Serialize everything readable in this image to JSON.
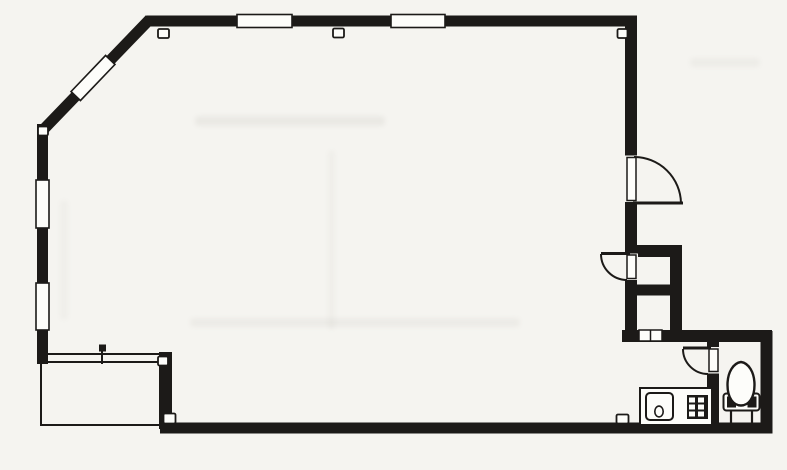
{
  "scene": {
    "width": 787,
    "height": 470,
    "background": "#f5f4f0",
    "paper": "#fdfdfa",
    "ink": "#1c1a18",
    "description": "Scanned architectural floor plan: large open room with angled corner, closet, kitchenette counter with sink and burner, WC with toilet, and balcony step-out"
  },
  "walls": [
    {
      "name": "top-wall",
      "x1": 147,
      "y1": 21,
      "x2": 637,
      "y2": 21,
      "w": 11
    },
    {
      "name": "diagonal-wall",
      "x1": 150,
      "y1": 19,
      "x2": 43,
      "y2": 130,
      "w": 11
    },
    {
      "name": "left-wall",
      "x1": 42.5,
      "y1": 124,
      "x2": 42.5,
      "y2": 364,
      "w": 11
    },
    {
      "name": "right-wall-upper",
      "x1": 631,
      "y1": 15.5,
      "x2": 631,
      "y2": 156,
      "w": 12
    },
    {
      "name": "right-wall-mid",
      "x1": 631,
      "y1": 202,
      "x2": 631,
      "y2": 254,
      "w": 12
    },
    {
      "name": "right-wall-lower",
      "x1": 631,
      "y1": 280,
      "x2": 631,
      "y2": 342,
      "w": 12
    },
    {
      "name": "closet-top-wall",
      "x1": 625,
      "y1": 251,
      "x2": 682,
      "y2": 251,
      "w": 12
    },
    {
      "name": "closet-right-wall",
      "x1": 676,
      "y1": 245,
      "x2": 676,
      "y2": 342,
      "w": 12
    },
    {
      "name": "closet-divider-wall",
      "x1": 625,
      "y1": 290,
      "x2": 682,
      "y2": 290,
      "w": 11
    },
    {
      "name": "service-top-wall",
      "x1": 622,
      "y1": 336,
      "x2": 772,
      "y2": 336,
      "w": 12
    },
    {
      "name": "wc-left-wall",
      "x1": 713,
      "y1": 331,
      "x2": 713,
      "y2": 430,
      "w": 12
    },
    {
      "name": "wc-right-wall",
      "x1": 766.5,
      "y1": 331,
      "x2": 766.5,
      "y2": 433,
      "w": 12
    },
    {
      "name": "bottom-wall",
      "x1": 160,
      "y1": 428,
      "x2": 772.5,
      "y2": 428,
      "w": 11
    },
    {
      "name": "balcony-right-wall",
      "x1": 165.5,
      "y1": 352,
      "x2": 165.5,
      "y2": 429,
      "w": 13
    }
  ],
  "thin_lines": [
    {
      "name": "balcony-top-line-outer",
      "x1": 40,
      "y1": 354,
      "x2": 160,
      "y2": 354
    },
    {
      "name": "balcony-top-line-inner",
      "x1": 40,
      "y1": 362,
      "x2": 160,
      "y2": 362
    },
    {
      "name": "balcony-left-line",
      "x1": 41,
      "y1": 362,
      "x2": 41,
      "y2": 426
    },
    {
      "name": "balcony-bottom-line",
      "x1": 41,
      "y1": 425,
      "x2": 162,
      "y2": 425
    },
    {
      "name": "balcony-tick-line",
      "x1": 102,
      "y1": 346,
      "x2": 102,
      "y2": 364
    }
  ],
  "windows": [
    {
      "name": "window-top-left",
      "cx": 264.5,
      "cy": 21,
      "len": 55,
      "th": 13,
      "rot": 0
    },
    {
      "name": "window-top-right",
      "cx": 418,
      "cy": 21,
      "len": 54,
      "th": 13,
      "rot": 0
    },
    {
      "name": "window-diagonal",
      "cx": 93,
      "cy": 78,
      "len": 50,
      "th": 13,
      "rot": -46.3
    },
    {
      "name": "window-left-upper",
      "cx": 42.5,
      "cy": 204,
      "len": 48,
      "th": 13,
      "rot": 90
    },
    {
      "name": "window-left-lower",
      "cx": 42.5,
      "cy": 306.5,
      "len": 47,
      "th": 13,
      "rot": 90
    }
  ],
  "doors": [
    {
      "name": "entry-door",
      "opening": {
        "x": 624,
        "y": 155.5,
        "w": 14,
        "h": 46.5
      },
      "slot": {
        "x": 627,
        "y": 157.5,
        "w": 9,
        "h": 43
      },
      "leaf": {
        "x1": 633,
        "y1": 203,
        "x2": 683,
        "y2": 203
      },
      "arc": "M 634 157 A 47 47 0 0 1 681 203"
    },
    {
      "name": "closet-door",
      "opening": {
        "x": 624,
        "y": 253.5,
        "w": 14,
        "h": 26.5
      },
      "slot": {
        "x": 627,
        "y": 255,
        "w": 9,
        "h": 23.5
      },
      "leaf": {
        "x1": 601,
        "y1": 253.5,
        "x2": 630,
        "y2": 253.5
      },
      "arc": "M 601 254 A 26 26 0 0 0 627 280"
    },
    {
      "name": "wc-door",
      "opening": {
        "x": 706.5,
        "y": 347,
        "w": 13,
        "h": 26.5
      },
      "slot": {
        "x": 709,
        "y": 349,
        "w": 9,
        "h": 22.5
      },
      "leaf": {
        "x1": 683,
        "y1": 348,
        "x2": 711,
        "y2": 348
      },
      "arc": "M 683 349 A 25 25 0 0 0 708 374"
    }
  ],
  "hatch": {
    "name": "closet-hatch",
    "x": 639,
    "y": 330,
    "w": 23,
    "h": 11,
    "divider_x": 650.5
  },
  "markers": [
    {
      "name": "column-marker-top-left",
      "x": 158,
      "y": 29,
      "w": 11,
      "h": 9
    },
    {
      "name": "column-marker-top-mid",
      "x": 333,
      "y": 28.5,
      "w": 11,
      "h": 9
    },
    {
      "name": "column-marker-top-right",
      "x": 617.5,
      "y": 29,
      "w": 10,
      "h": 9
    },
    {
      "name": "column-marker-corner-left",
      "x": 38,
      "y": 126.5,
      "w": 10,
      "h": 9
    },
    {
      "name": "column-marker-balcony-top",
      "x": 158,
      "y": 356.5,
      "w": 10,
      "h": 9
    },
    {
      "name": "column-marker-balcony-bottom",
      "x": 163.5,
      "y": 413.5,
      "w": 12,
      "h": 10
    },
    {
      "name": "column-marker-bottom-mid",
      "x": 616.5,
      "y": 414.5,
      "w": 12,
      "h": 9
    }
  ],
  "tick_dot": {
    "x": 99,
    "y": 344.5,
    "w": 7,
    "h": 7
  },
  "kitchen": {
    "counter": {
      "x": 640,
      "y": 388,
      "w": 72,
      "h": 37
    },
    "sink": {
      "x": 646,
      "y": 393,
      "w": 27,
      "h": 27,
      "rx": 4
    },
    "drain": {
      "cx": 659,
      "cy": 411.5,
      "rx": 4.2,
      "ry": 5.4
    },
    "burner": {
      "x": 687,
      "y": 395,
      "w": 21,
      "h": 24
    },
    "burner_cells": [
      {
        "x": 689,
        "y": 397.5,
        "w": 6,
        "h": 5
      },
      {
        "x": 698,
        "y": 397.5,
        "w": 6,
        "h": 5
      },
      {
        "x": 689,
        "y": 404.5,
        "w": 6,
        "h": 5
      },
      {
        "x": 698,
        "y": 404.5,
        "w": 6,
        "h": 5
      },
      {
        "x": 689,
        "y": 411.5,
        "w": 6,
        "h": 5
      },
      {
        "x": 698,
        "y": 411.5,
        "w": 6,
        "h": 5
      }
    ]
  },
  "toilet": {
    "tank": {
      "x": 723.5,
      "y": 393.5,
      "w": 36,
      "h": 17,
      "rx": 3
    },
    "bolts": [
      {
        "x": 727,
        "y": 396.5,
        "w": 9,
        "h": 11
      },
      {
        "x": 747.5,
        "y": 396.5,
        "w": 9,
        "h": 11
      }
    ],
    "bowl": "M 741 362 C 733.5 363 727.5 372 727.5 385 C 727.5 398 733.5 405.5 741 405.5 C 748.5 405.5 754.5 398 754.5 385 C 754.5 372 748.5 363 741 362 Z",
    "legs": [
      {
        "x1": 731,
        "y1": 410.5,
        "x2": 731,
        "y2": 424
      },
      {
        "x1": 752,
        "y1": 410.5,
        "x2": 752,
        "y2": 424
      }
    ]
  },
  "smudges": [
    {
      "x": 195,
      "y": 116,
      "w": 190,
      "h": 10,
      "o": 0.1
    },
    {
      "x": 190,
      "y": 318,
      "w": 330,
      "h": 9,
      "o": 0.08
    },
    {
      "x": 328,
      "y": 150,
      "w": 7,
      "h": 180,
      "o": 0.05
    },
    {
      "x": 690,
      "y": 58,
      "w": 70,
      "h": 9,
      "o": 0.07
    },
    {
      "x": 60,
      "y": 200,
      "w": 8,
      "h": 120,
      "o": 0.05
    }
  ]
}
